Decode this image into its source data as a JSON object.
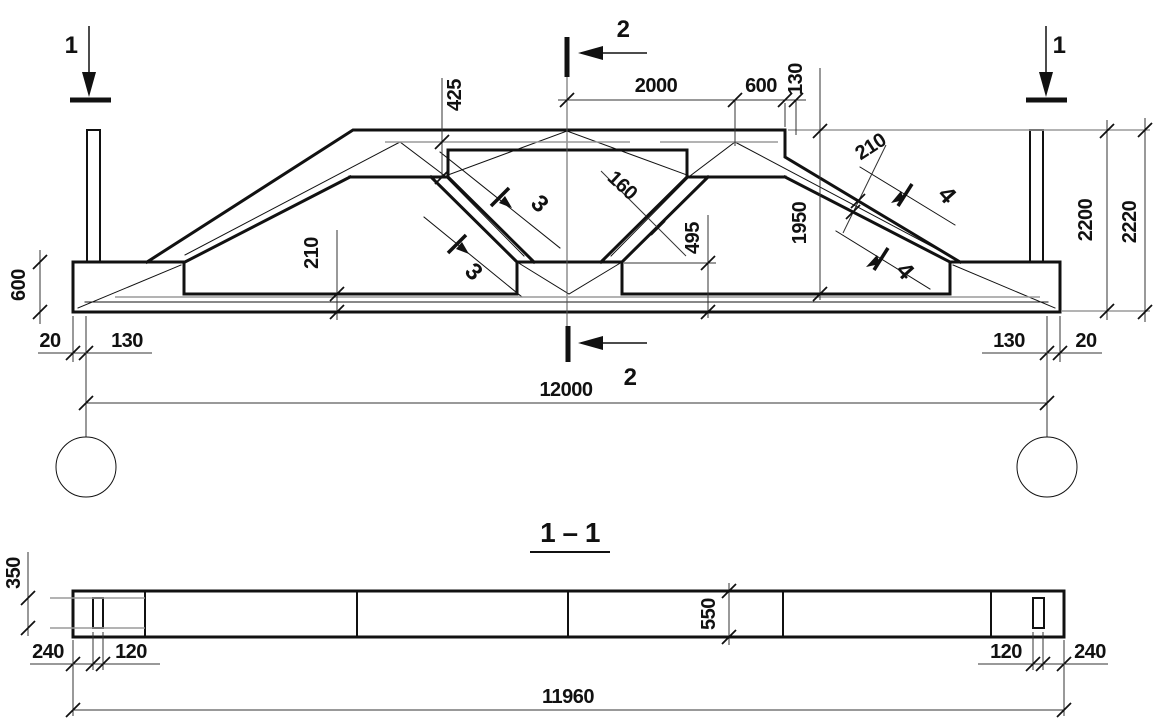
{
  "drawing": {
    "type": "structural-engineering-drawing",
    "views": {
      "elevation": "truss girder elevation with section cut marks",
      "section": "longitudinal section 1 - 1"
    },
    "section_title": "1 - 1"
  },
  "colors": {
    "line": "#111111",
    "reinforcement_gray": "#9a9a9a",
    "background": "#ffffff"
  },
  "labels": {
    "sec1": "1",
    "sec2": "2",
    "sec3": "3",
    "sec4": "4",
    "section_title": "1 – 1"
  },
  "dims": {
    "d2000": "2000",
    "d600_top": "600",
    "d130_top": "130",
    "d425": "425",
    "d160": "160",
    "d495": "495",
    "d1950": "1950",
    "d210_chord": "210",
    "d210_bottom": "210",
    "d2200": "2200",
    "d2220": "2220",
    "d600_left": "600",
    "d20_left": "20",
    "d130_left": "130",
    "d130_right": "130",
    "d20_right": "20",
    "d12000": "12000",
    "d350": "350",
    "d550": "550",
    "d240_left": "240",
    "d120_left": "120",
    "d120_right": "120",
    "d240_right": "240",
    "d11960": "11960"
  }
}
